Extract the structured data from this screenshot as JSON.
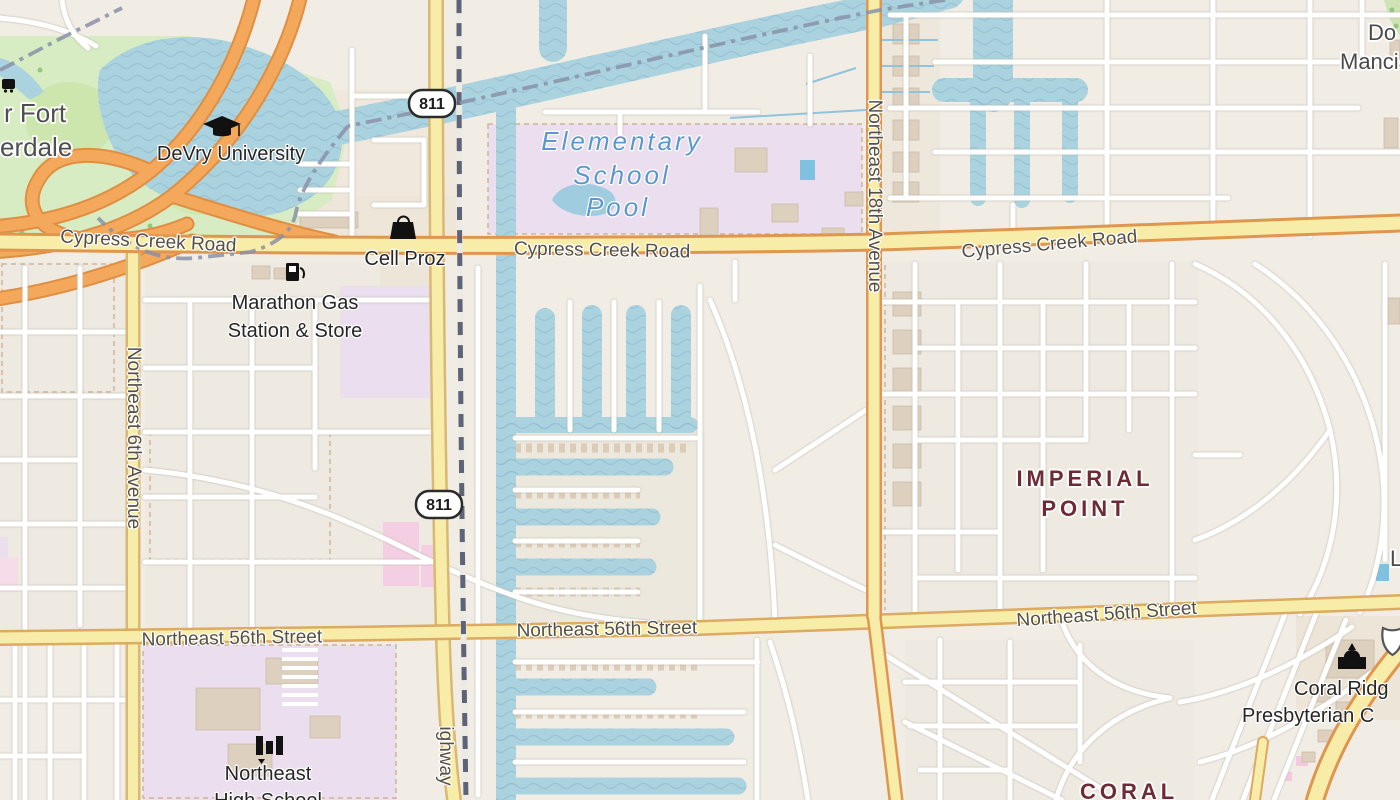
{
  "map_area": "Fort Lauderdale – Cypress Creek / Imperial Point",
  "colors": {
    "land": "#f1ede5",
    "residential_block": "#ece6dc",
    "water": "#aad3df",
    "water_wave": "#8cb8ce",
    "park_green": "#d7ecc3",
    "school_purple": "#eadeef",
    "retail_pink": "#f4cfe4",
    "road_fill_yellow": "#f8eda8",
    "primary_casing_orange": "#e0964e",
    "secondary_casing": "#d9b873",
    "minor_road": "#ffffff",
    "railway": "#5d6477",
    "admin_boundary": "#8a92a8",
    "neighborhood_text": "#6e2b36",
    "water_text": "#5b98cd",
    "road_text": "#554f45",
    "poi_text": "#262626",
    "building": "#ddd0bf"
  },
  "shields": {
    "route_811": "811"
  },
  "labels": {
    "city": {
      "line1": "r Fort",
      "line2": "erdale"
    },
    "devry": "DeVry University",
    "cypress_creek": "Cypress Creek Road",
    "cell_proz": "Cell Proz",
    "marathon": {
      "line1": "Marathon Gas",
      "line2": "Station & Store"
    },
    "elementary": {
      "line1": "Elementary",
      "line2": "School",
      "line3": "Pool"
    },
    "ne_6th": "Northeast 6th Avenue",
    "ne_18th": "Northeast 18th Avenue",
    "dixie_fragment": "ighway",
    "imperial": {
      "line1": "IMPERIAL",
      "line2": "POINT"
    },
    "ne_56th": "Northeast 56th Street",
    "coral_ridge_church": {
      "line1": "Coral Ridg",
      "line2": "Presbyterian C"
    },
    "ne_high": {
      "line1": "Northeast",
      "line2": "High School"
    },
    "coral_fragment": "CORAL",
    "park_fragment": {
      "line1": "Do",
      "line2": "Manci"
    },
    "right_edge_fragment": "L"
  }
}
